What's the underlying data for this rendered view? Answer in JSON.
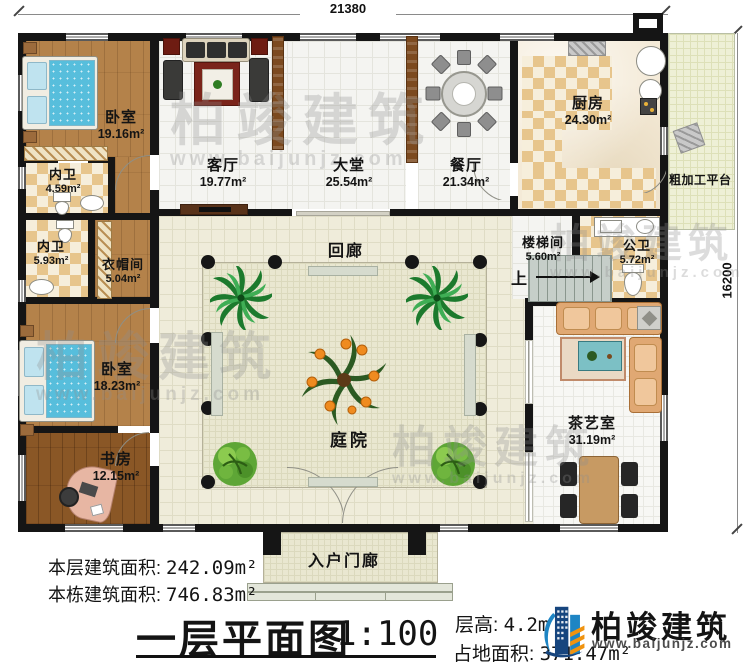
{
  "dimensions": {
    "top": "21380",
    "right": "16200"
  },
  "watermark": {
    "name": "柏竣建筑",
    "url": "www.baijunjz.com"
  },
  "rooms": {
    "bedroom1": {
      "name": "卧室",
      "area": "19.16m²"
    },
    "bath1": {
      "name": "内卫",
      "area": "4.59m²"
    },
    "bath2": {
      "name": "内卫",
      "area": "5.93m²"
    },
    "cloakroom": {
      "name": "衣帽间",
      "area": "5.04m²"
    },
    "bedroom2": {
      "name": "卧室",
      "area": "18.23m²"
    },
    "study": {
      "name": "书房",
      "area": "12.15m²"
    },
    "living": {
      "name": "客厅",
      "area": "19.77m²"
    },
    "hall": {
      "name": "大堂",
      "area": "25.54m²"
    },
    "dining": {
      "name": "餐厅",
      "area": "21.34m²"
    },
    "kitchen": {
      "name": "厨房",
      "area": "24.30m²"
    },
    "platform": {
      "name": "粗加工平台"
    },
    "corridor": {
      "name": "回廊"
    },
    "stairwell": {
      "name": "楼梯间",
      "area": "5.60m²"
    },
    "publicbath": {
      "name": "公卫",
      "area": "5.72m²"
    },
    "tearoom": {
      "name": "茶艺室",
      "area": "31.19m²"
    },
    "courtyard": {
      "name": "庭院"
    },
    "porch": {
      "name": "入户门廊"
    },
    "stairs_up": "上"
  },
  "footer": {
    "floor_area_label": "本层建筑面积:",
    "floor_area": "242.09m²",
    "building_area_label": "本栋建筑面积:",
    "building_area": "746.83m²",
    "title": "一层平面图",
    "scale": "1:100",
    "height_label": "层高:",
    "height": "4.2m",
    "land_label": "占地面积:",
    "land_area": "371.47m²"
  },
  "brand": {
    "name": "柏竣建筑",
    "url": "www.baijunjz.com",
    "blue": "#16457e",
    "light_blue": "#1e85c4",
    "orange": "#f0930f"
  }
}
